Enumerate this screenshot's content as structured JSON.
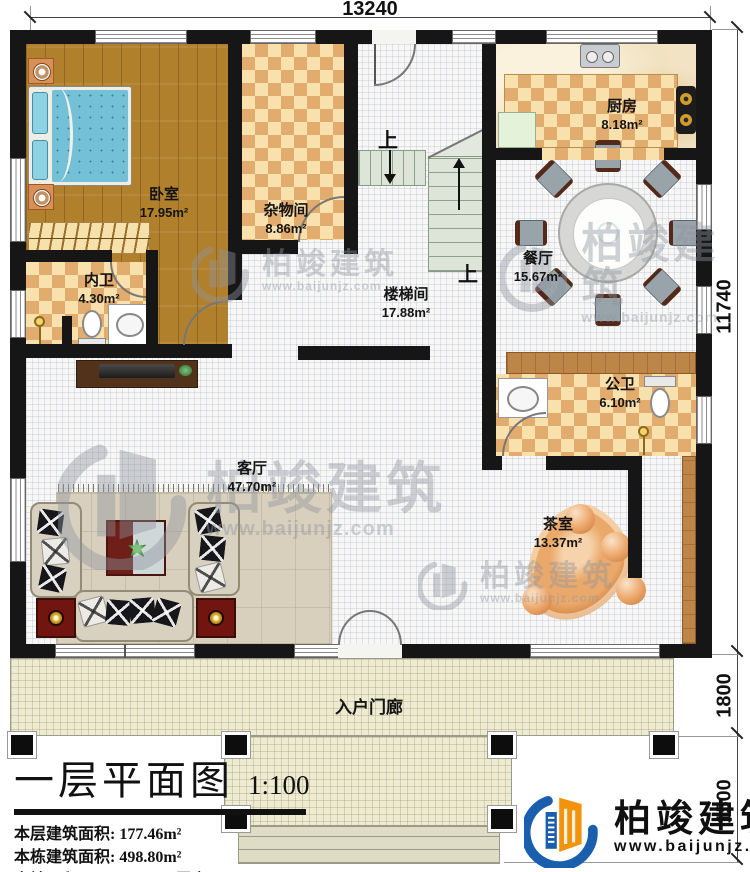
{
  "dimensions": {
    "top": "13240",
    "right_upper": "11740",
    "right_mid": "1800",
    "right_lower": "1500"
  },
  "rooms": {
    "bedroom": {
      "name": "卧室",
      "area": "17.95m²"
    },
    "storage": {
      "name": "杂物间",
      "area": "8.86m²"
    },
    "kitchen": {
      "name": "厨房",
      "area": "8.18m²"
    },
    "dining": {
      "name": "餐厅",
      "area": "15.67m²"
    },
    "stairwell": {
      "name": "楼梯间",
      "area": "17.88m²"
    },
    "private_bath": {
      "name": "内卫",
      "area": "4.30m²"
    },
    "public_bath": {
      "name": "公卫",
      "area": "6.10m²"
    },
    "living": {
      "name": "客厅",
      "area": "47.70m²"
    },
    "tea": {
      "name": "茶室",
      "area": "13.37m²"
    },
    "porch": {
      "name": "入户门廊"
    }
  },
  "stairs": {
    "up": "上"
  },
  "info_panel": {
    "title": "一层平面图",
    "scale": "1:100",
    "line1_label": "本层建筑面积:",
    "line1_value": "177.46m²",
    "line2_label": "本栋建筑面积:",
    "line2_value": "498.80m²",
    "line3a_label": "占地面积:",
    "line3a_value": "193.55m²",
    "line3b_label": "层高:",
    "line3b_value": "3.9m"
  },
  "branding": {
    "company": "柏竣建筑",
    "website": "www.baijunjz.com"
  },
  "watermark": {
    "company": "柏竣建筑",
    "website": "www.baijunjz.com"
  },
  "colors": {
    "wall": "#161616",
    "checker_dark": "#e3ac6f",
    "checker_light": "#f9e1ad",
    "wood": "#b1802d",
    "brand_blue": "#1a5fae",
    "brand_orange": "#f2930d"
  }
}
